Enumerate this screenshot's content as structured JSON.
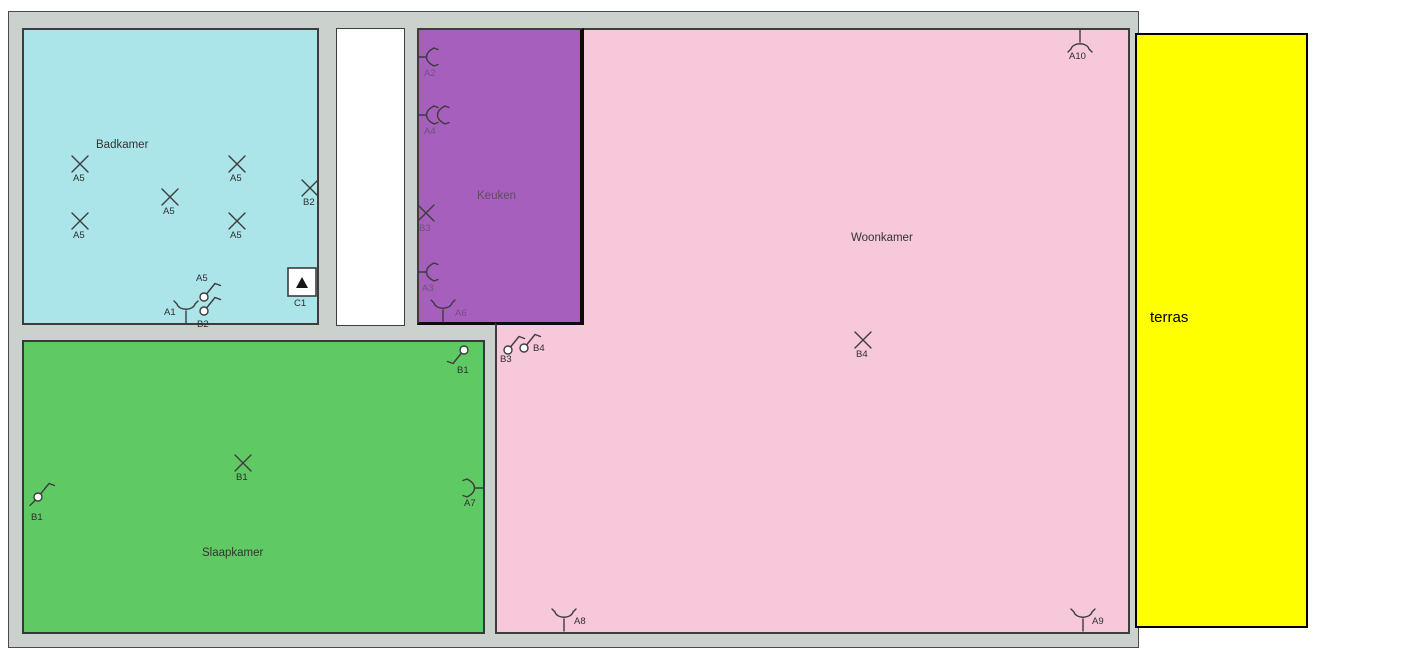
{
  "rooms": {
    "badkamer": {
      "label": "Badkamer"
    },
    "keuken": {
      "label": "Keuken"
    },
    "woonkamer": {
      "label": "Woonkamer"
    },
    "slaapkamer": {
      "label": "Slaapkamer"
    },
    "terras": {
      "label": "terras"
    }
  },
  "colors": {
    "wall": "#cbd1cd",
    "badkamer": "#abe4e9",
    "corridor": "#ffffff",
    "keuken": "#a65fbd",
    "woonkamer": "#f6c8d9",
    "slaapkamer": "#5fca63",
    "terras": "#ffff00"
  },
  "symbols": [
    {
      "type": "lamp-x",
      "x": 80,
      "y": 164,
      "label": "A5",
      "lx": 73,
      "ly": 181
    },
    {
      "type": "lamp-x",
      "x": 237,
      "y": 164,
      "label": "A5",
      "lx": 230,
      "ly": 181
    },
    {
      "type": "lamp-x",
      "x": 170,
      "y": 197,
      "label": "A5",
      "lx": 163,
      "ly": 214
    },
    {
      "type": "lamp-x",
      "x": 80,
      "y": 221,
      "label": "A5",
      "lx": 73,
      "ly": 238
    },
    {
      "type": "lamp-x",
      "x": 237,
      "y": 221,
      "label": "A5",
      "lx": 230,
      "ly": 238
    },
    {
      "type": "lamp-x",
      "x": 310,
      "y": 188,
      "label": "B2",
      "lx": 303,
      "ly": 205
    },
    {
      "type": "detector",
      "x": 302,
      "y": 282,
      "label": "C1",
      "lx": 294,
      "ly": 306
    },
    {
      "type": "switch",
      "x": 204,
      "y": 297,
      "rot": 0,
      "label": "A5",
      "lx": 196,
      "ly": 281
    },
    {
      "type": "switch",
      "x": 204,
      "y": 311,
      "rot": 0,
      "label": "B2",
      "lx": 197,
      "ly": 327
    },
    {
      "type": "ceiling-fork",
      "x": 186,
      "y": 309,
      "rot": 0,
      "label": "A1",
      "lx": 164,
      "ly": 315
    },
    {
      "type": "wall-light",
      "x": 430,
      "y": 57,
      "rot": 0,
      "label": "A2",
      "lx": 424,
      "ly": 76,
      "faint": true
    },
    {
      "type": "wall-light-double",
      "x": 430,
      "y": 115,
      "rot": 0,
      "label": "A4",
      "lx": 424,
      "ly": 134,
      "faint": true
    },
    {
      "type": "lamp-x",
      "x": 426,
      "y": 213,
      "label": "B3",
      "lx": 419,
      "ly": 231,
      "faint": true
    },
    {
      "type": "wall-light",
      "x": 430,
      "y": 272,
      "rot": 0,
      "label": "A3",
      "lx": 422,
      "ly": 291,
      "faint": true
    },
    {
      "type": "ceiling-fork",
      "x": 443,
      "y": 308,
      "rot": 0,
      "label": "A6",
      "lx": 455,
      "ly": 316,
      "faint": true
    },
    {
      "type": "switch",
      "x": 508,
      "y": 350,
      "rot": 0,
      "label": "B3",
      "lx": 500,
      "ly": 362
    },
    {
      "type": "switch",
      "x": 524,
      "y": 348,
      "rot": 0,
      "label": "B4",
      "lx": 533,
      "ly": 351
    },
    {
      "type": "lamp-x",
      "x": 863,
      "y": 340,
      "label": "B4",
      "lx": 856,
      "ly": 357
    },
    {
      "type": "ceiling-fork",
      "x": 1080,
      "y": 44,
      "rot": 180,
      "label": "A10",
      "lx": 1069,
      "ly": 59
    },
    {
      "type": "ceiling-fork",
      "x": 564,
      "y": 617,
      "rot": 0,
      "label": "A8",
      "lx": 574,
      "ly": 624
    },
    {
      "type": "ceiling-fork",
      "x": 1083,
      "y": 617,
      "rot": 0,
      "label": "A9",
      "lx": 1092,
      "ly": 624
    },
    {
      "type": "switch",
      "x": 38,
      "y": 497,
      "rot": 0,
      "tail": true,
      "label": "B1",
      "lx": 31,
      "ly": 520
    },
    {
      "type": "lamp-x",
      "x": 243,
      "y": 463,
      "label": "B1",
      "lx": 236,
      "ly": 480
    },
    {
      "type": "switch",
      "x": 464,
      "y": 350,
      "rot": 180,
      "label": "B1",
      "lx": 457,
      "ly": 373
    },
    {
      "type": "wall-light",
      "x": 471,
      "y": 488,
      "rot": 180,
      "label": "A7",
      "lx": 464,
      "ly": 506
    }
  ]
}
